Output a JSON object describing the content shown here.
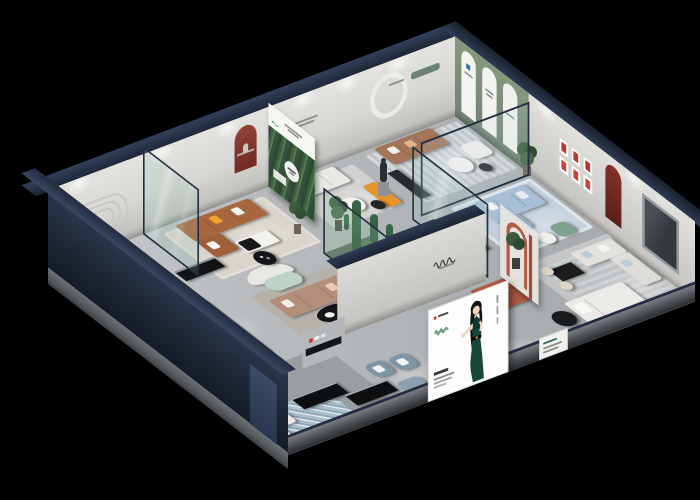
{
  "scene": {
    "title": "Isometric cutaway 3D render of a furniture showroom floor plan on a black background",
    "style": "dollhouse aerial cutaway, recessed spotlights, no legible text",
    "background": "#000000",
    "palette": {
      "exterior_wall_navy": "#1d2533",
      "roof_edge_navy": "#2b3850",
      "interior_wall": "#dddcd8",
      "floor_gray": "#b9bcbe",
      "slab_gray": "#6a6d70",
      "sage_accent_wall": "#7f8f80",
      "teal_sofa": "#5e7c7b",
      "caramel_leather": "#a8663e",
      "taupe_sectional": "#b28e7b",
      "light_blue_sofa": "#a6bed6",
      "terracotta": "#b55c44",
      "blue_gray_armchair": "#7e95a6",
      "orange_accent": "#e8932c",
      "red_niche": "#8d3a31",
      "glass_green": "rgba(150,195,180,0.2)",
      "poster_logo_green": "#2aa365",
      "logo_red": "#d03326"
    },
    "architecture": {
      "view": "isometric from south-west, roof removed",
      "exterior": "tall dark navy wall on front-left, low gray slab edge on front-right",
      "back_left_wall_features": [
        "rounded recessed moulding panel",
        "dark red arched niche with vase",
        "small caption text",
        "white circular arch",
        "teal recessed slot"
      ],
      "back_right_wall_features": [
        "sage green section with three white arched banner niches",
        "six small red-framed prints",
        "dark red arched niche",
        "dark framed window"
      ]
    },
    "rooms": [
      {
        "name": "teal-sofa-lounge",
        "furniture": [
          "teal fabric sofa with orange and white pillows",
          "round white coffee table",
          "striped gray rug",
          "tall potted plant",
          "dark side stool"
        ]
      },
      {
        "name": "caramel-leather-lounge",
        "furniture": [
          "caramel leather sectional with yellow and white pillows",
          "white coffee table with black tray",
          "beige rug",
          "glass divider panel"
        ]
      },
      {
        "name": "white-sofa-gallery",
        "furniture": [
          "white sofa",
          "orange display bench",
          "bronze statue on pedestal",
          "round side tables",
          "potted plant"
        ]
      },
      {
        "name": "tan-sofa-lounge",
        "furniture": [
          "tan leather sofa with white pillows",
          "white armchair",
          "round coffee tables",
          "striped rug",
          "dark cabinet"
        ]
      },
      {
        "name": "bedroom-vignette",
        "furniture": [
          "light blue sofa bed with white pillows",
          "dark media bench",
          "pale blue rug",
          "green accent chair",
          "glass corner walls",
          "potted plant"
        ]
      },
      {
        "name": "white-lounge-right",
        "furniture": [
          "white L-shaped sofa with light blue cushions",
          "black dining table with two cream chairs",
          "white display bed",
          "black round table",
          "potted plant"
        ]
      },
      {
        "name": "terracotta-vignette",
        "furniture": [
          "terracotta sofa with white cushions",
          "terracotta arch display frame"
        ]
      },
      {
        "name": "center-lounge",
        "furniture": [
          "taupe sectional sofa",
          "black oval coffee table with white tray",
          "mint curved bench",
          "white curved screen",
          "black round drinks table"
        ]
      },
      {
        "name": "cactus-atrium",
        "furniture": [
          "green-tinted glass enclosure",
          "tall cacti",
          "white pebble bed"
        ]
      },
      {
        "name": "dining-area",
        "furniture": [
          "black oval dining table",
          "four cream chairs",
          "white shelf with red accent",
          "long black sideboard"
        ]
      },
      {
        "name": "entry-gallery",
        "furniture": [
          "blue mosaic rug",
          "white bench",
          "two black display benches",
          "white reception counter",
          "two blue-gray armchairs",
          "blue-gray ottoman",
          "black console",
          "white leaning sign boards"
        ]
      }
    ],
    "front_poster": {
      "type": "illuminated billboard on front wall",
      "background": "#ffffff",
      "figure": "illustrated woman with long black hair wearing a dark green halter dress, left palm open",
      "logo_color": "#2aa365",
      "accent_mark": "#d03326",
      "has_vertical_caption": true,
      "text_legible": false
    },
    "mural": {
      "type": "forest photo mural wall panel",
      "logo_color": "#2aa365",
      "emblem": "white circular badge"
    },
    "signage": [
      {
        "type": "brand-script-logo",
        "location": "central partition wall"
      },
      {
        "type": "red-and-white-mini-logo",
        "location": "low shelf wall"
      },
      {
        "type": "small-white-sign-boards",
        "location": "front slab"
      }
    ],
    "lighting": "recessed ceiling spotlights producing pools of light on floors and wall washes"
  }
}
